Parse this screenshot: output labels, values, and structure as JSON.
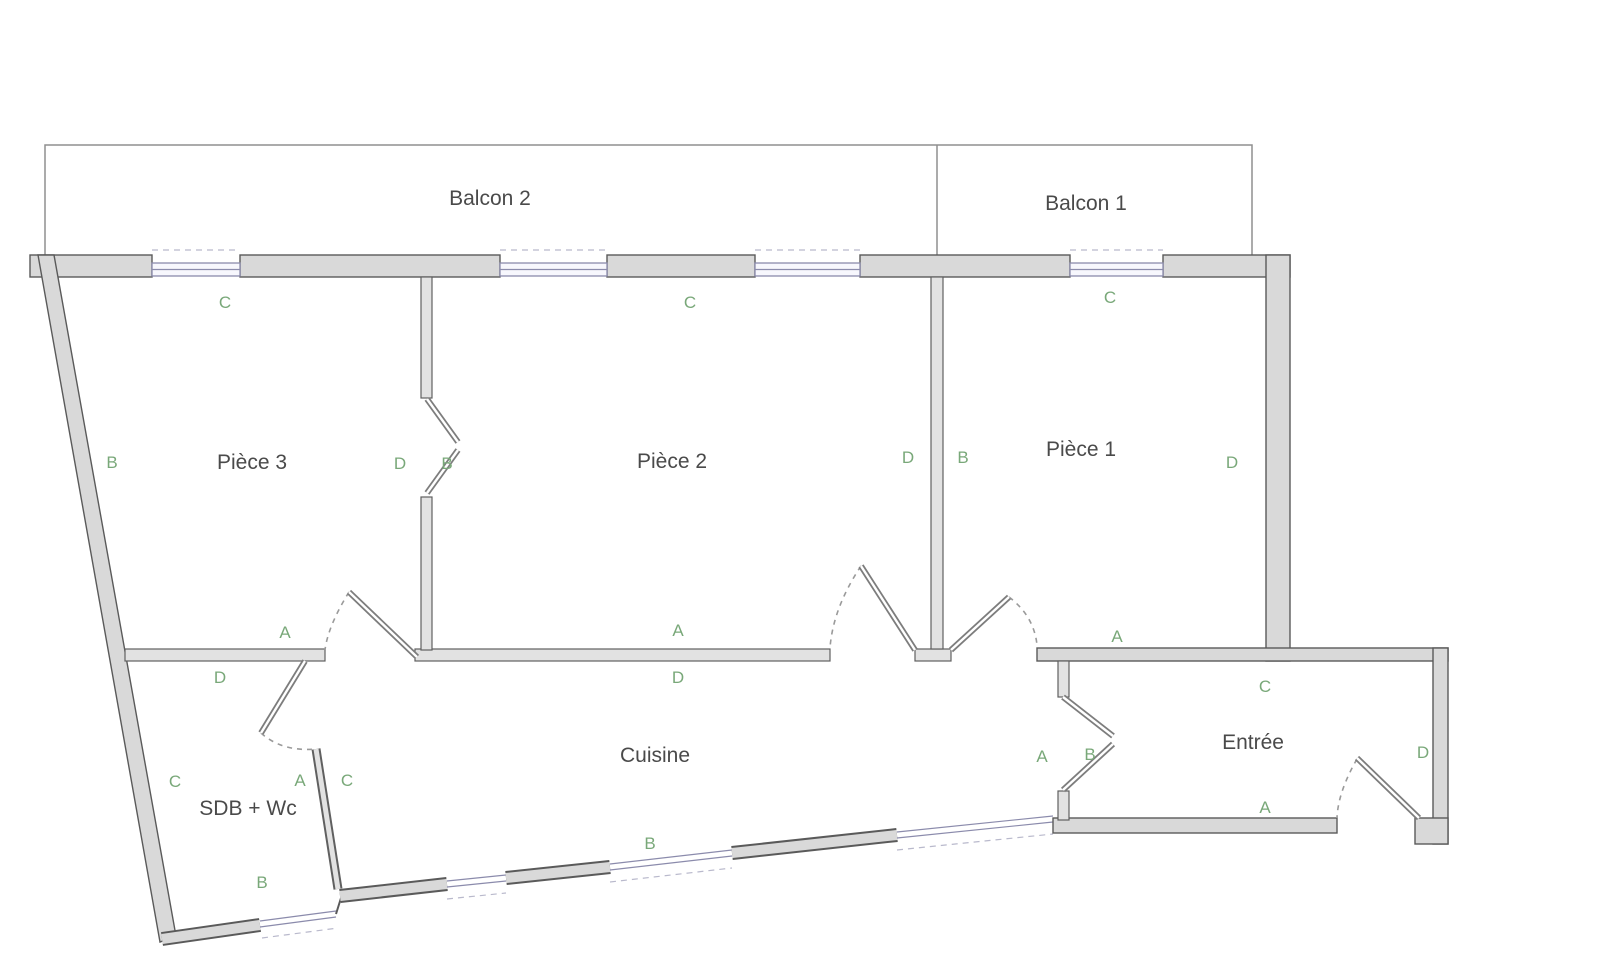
{
  "rooms": {
    "balcon2": "Balcon 2",
    "balcon1": "Balcon 1",
    "piece3": "Pièce 3",
    "piece2": "Pièce 2",
    "piece1": "Pièce 1",
    "cuisine": "Cuisine",
    "sdb": "SDB + Wc",
    "entree": "Entrée"
  },
  "wall_markers": [
    "C",
    "C",
    "C",
    "B",
    "D",
    "B",
    "D",
    "B",
    "D",
    "A",
    "A",
    "A",
    "D",
    "D",
    "C",
    "A",
    "B",
    "D",
    "A",
    "B",
    "C",
    "A",
    "C",
    "B"
  ],
  "colors": {
    "wall_fill": "#d9d9d9",
    "wall_stroke": "#5a5a5a",
    "partition_fill": "#e2e2e2",
    "window_line": "#8b8bac",
    "marker_green": "#79a879",
    "label_gray": "#4a4a4a",
    "balcony_line": "#8f8f8f",
    "background": "#ffffff"
  }
}
